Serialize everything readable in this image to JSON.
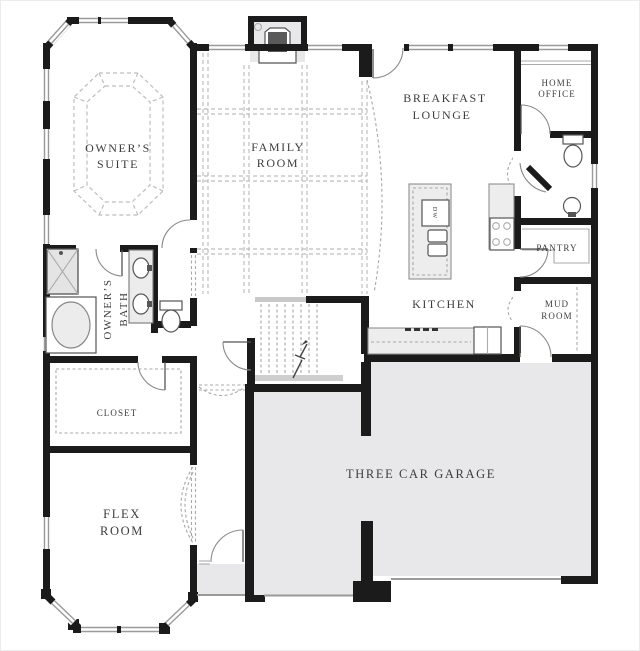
{
  "rooms": {
    "owners_suite": {
      "line1": "OWNER’S",
      "line2": "SUITE"
    },
    "family_room": {
      "line1": "FAMILY",
      "line2": "ROOM"
    },
    "breakfast_lounge": {
      "line1": "BREAKFAST",
      "line2": "LOUNGE"
    },
    "home_office": {
      "line1": "HOME",
      "line2": "OFFICE"
    },
    "pantry": {
      "label": "PANTRY"
    },
    "mud_room": {
      "line1": "MUD",
      "line2": "ROOM"
    },
    "kitchen": {
      "label": "KITCHEN"
    },
    "owners_bath": {
      "line1": "OWNER’S",
      "line2": "BATH"
    },
    "closet": {
      "label": "CLOSET"
    },
    "flex_room": {
      "line1": "FLEX",
      "line2": "ROOM"
    },
    "garage": {
      "label": "THREE CAR GARAGE"
    }
  },
  "fixtures": {
    "dishwasher_label": "DW"
  },
  "colors": {
    "wall": "#1b1b1b",
    "window": "#9a9a9a",
    "dash": "#bdbdbd",
    "door": "#8a8a8a",
    "counter": "#ededee",
    "fill": "#e8e8ea",
    "label": "#3d3d3d"
  }
}
